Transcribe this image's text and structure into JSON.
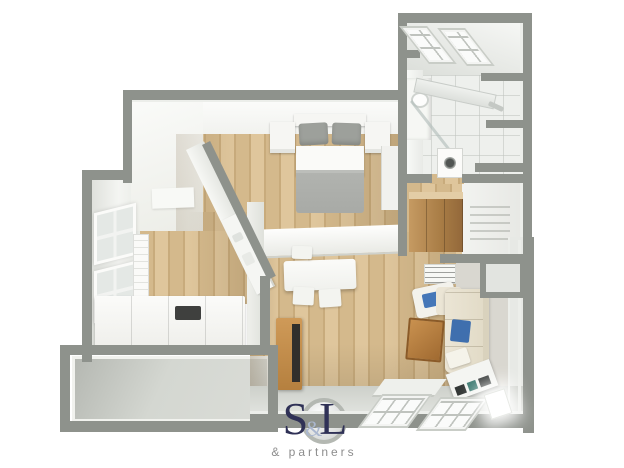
{
  "watermark": {
    "brand_s": "S",
    "brand_amp": "&",
    "brand_l": "L",
    "tagline": "& partners"
  },
  "palette": {
    "background": "#ffffff",
    "wall_exterior": "#8e928c",
    "wall_trim": "#eceeea",
    "wall_face": "#f4f5f1",
    "floor_wood_light": "#dfc69c",
    "floor_wood_mid": "#d4b98c",
    "floor_wood_dark": "#c8ab7c",
    "floor_gray": "#d4d7d1",
    "tile_white": "#eef0ed",
    "bed_blanket": "#a8aaa6",
    "bed_pillow": "#9da09b",
    "sofa_cream": "#ebe5d5",
    "cushion_blue": "#4577b8",
    "wood_furniture": "#b5803f",
    "brand_navy": "#2f3156",
    "brand_amp": "#aab7cf",
    "tagline_gray": "#8d8d8d"
  },
  "scene": {
    "type": "3d-floor-plan",
    "rooms": [
      {
        "name": "bedroom",
        "furniture": [
          "double-bed",
          "gray-pillows",
          "gray-blanket",
          "nightstand-left",
          "nightstand-right",
          "wardrobe"
        ]
      },
      {
        "name": "bathroom",
        "furniture": [
          "skylight-window",
          "skylight-window",
          "vanity-sink",
          "mirror-shelf",
          "shower-glass",
          "washing-machine"
        ]
      },
      {
        "name": "hallway-closet",
        "furniture": [
          "wood-wardrobe",
          "radiator"
        ]
      },
      {
        "name": "study-room",
        "furniture": [
          "window",
          "window",
          "radiator-shelf",
          "daybed",
          "tray"
        ]
      },
      {
        "name": "living-dining-room",
        "furniture": [
          "kitchen-counter",
          "dining-table",
          "chairs",
          "wall-shelf",
          "armchair",
          "corner-sofa",
          "blue-cushions",
          "coffee-table",
          "media-sideboard",
          "glow-lamp",
          "floor-panel",
          "roof-window",
          "roof-window",
          "paper-floor-lamp",
          "tv-cabinet"
        ]
      },
      {
        "name": "balcony",
        "furniture": []
      }
    ]
  }
}
